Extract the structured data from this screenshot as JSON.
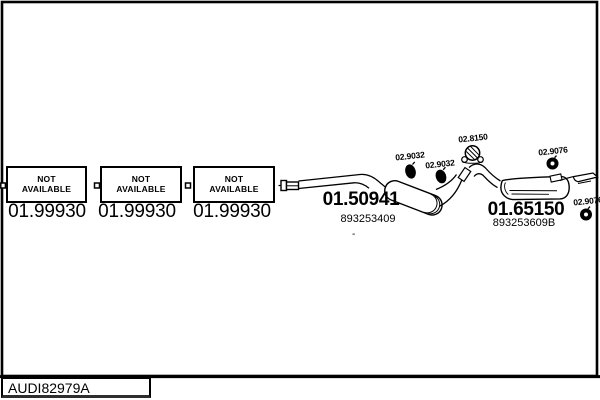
{
  "colors": {
    "ink": "#000000",
    "paper": "#ffffff"
  },
  "catalog": {
    "placeholder_boxes": [
      {
        "line1": "NOT",
        "line2": "AVAILABLE",
        "part_number": "01.99930"
      },
      {
        "line1": "NOT",
        "line2": "AVAILABLE",
        "part_number": "01.99930"
      },
      {
        "line1": "NOT",
        "line2": "AVAILABLE",
        "part_number": "01.99930"
      }
    ],
    "front_silencer": {
      "part_number": "01.50941",
      "oe_number": "893253409"
    },
    "rear_silencer": {
      "part_number": "01.65150",
      "oe_number": "893253609B"
    },
    "mounting_parts": {
      "clamp_1": "02.9032",
      "clamp_2": "02.9032",
      "rubber_hanger": "02.8150",
      "ring_1": "02.9076",
      "ring_2": "02.9076"
    },
    "separator_dash": "-",
    "footer_code": "AUDI82979A"
  },
  "icons": {
    "clamp": "filled-oval-clamp-icon",
    "rubber_hanger": "hatched-circle-hanger-icon",
    "ring": "donut-ring-icon"
  }
}
